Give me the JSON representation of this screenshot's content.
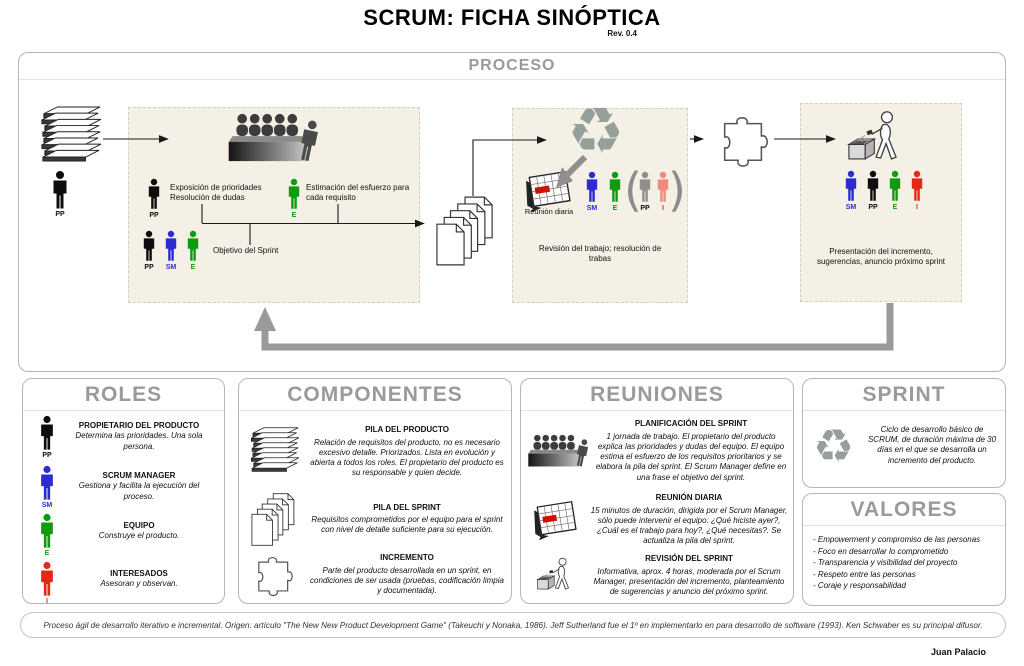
{
  "title": "SCRUM: FICHA SINÓPTICA",
  "revision": "Rev. 0.4",
  "author": "Juan Palacio",
  "footer": "Proceso ágil de desarrollo iterativo e incremental. Origen: artículo \"The New New Product Development Game\" (Takeuchi y Nonaka, 1986). Jeff Sutherland fue el 1º en implementarlo en para desarrollo de software (1993). Ken Schwaber es su principal difusor.",
  "labels": {
    "pp": "PP",
    "sm": "SM",
    "e": "E",
    "i": "I"
  },
  "icons": {
    "recycle": "♻",
    "paren_open": "(",
    "paren_close": ")"
  },
  "colors": {
    "pp": "#0d0d0d",
    "sm": "#2b2bd0",
    "e": "#0f9b0f",
    "i": "#e3281a",
    "ghost_pp": "#8f8f8f",
    "ghost_i": "#f0897f",
    "beige": "#f5f0e6",
    "gray_heading": "#9a9a9a",
    "arrow_gray": "#9a9a9a",
    "board_red": "#cf1000"
  },
  "proceso": {
    "heading": "PROCESO",
    "box1": {
      "exposicion": "Exposición de prioridades\nResolución de dudas",
      "estimacion": "Estimación del esfuerzo para cada requisito",
      "objetivo": "Objetivo del Sprint"
    },
    "box2": {
      "reunion_diaria": "Reunión diaria",
      "revision": "Revisión del trabajo; resolución de trabas"
    },
    "box3": {
      "presentacion": "Presentación del incremento, sugerencias, anuncio próximo sprint"
    }
  },
  "roles": {
    "heading": "ROLES",
    "items": [
      {
        "label": "PP",
        "title": "PROPIETARIO DEL PRODUCTO",
        "desc": "Determina las prioridades. Una sola persona."
      },
      {
        "label": "SM",
        "title": "SCRUM MANAGER",
        "desc": "Gestiona y facilita la ejecución del proceso."
      },
      {
        "label": "E",
        "title": "EQUIPO",
        "desc": "Construye el producto."
      },
      {
        "label": "I",
        "title": "INTERESADOS",
        "desc": "Asesoran y observan."
      }
    ]
  },
  "componentes": {
    "heading": "COMPONENTES",
    "items": [
      {
        "title": "PILA DEL PRODUCTO",
        "desc": "Relación de requisitos del producto, no es necesario excesivo detalle. Priorizados. Lista en evolución y abierta a todos los roles.  El propietario del producto es su responsable y quien decide."
      },
      {
        "title": "PILA DEL SPRINT",
        "desc": "Requisitos comprometidos por el equipo para el sprint con nivel de detalle suficiente para su ejecución."
      },
      {
        "title": "INCREMENTO",
        "desc": "Parte del producto desarrollada en un sprint, en condiciones de ser usada (pruebas, codificación limpia y documentada)."
      }
    ]
  },
  "reuniones": {
    "heading": "REUNIONES",
    "items": [
      {
        "title": "PLANIFICACIÓN DEL SPRINT",
        "desc": "1 jornada de trabajo. El propietario del producto explica las prioridades y  dudas del equipo. El equipo estima el esfuerzo de los requisitos prioritarios y se elabora la pila del sprint. El Scrum Manager define en una frase el objetivo del sprint."
      },
      {
        "title": "REUNIÓN DIARIA",
        "desc": "15 minutos de duración, dirigida por el Scrum Manager, sólo puede intervenir el equipo: ¿Qué hiciste ayer?, ¿Cuál es el trabajo para hoy?, ¿Qué necesitas?. Se actualiza la pila del sprint."
      },
      {
        "title": "REVISIÓN DEL SPRINT",
        "desc": "Informativa, aprox. 4 horas, moderada por el Scrum Manager, presentación del incremento, planteamiento de sugerencias y anuncio del próximo sprint."
      }
    ]
  },
  "sprint": {
    "heading": "SPRINT",
    "desc": "Ciclo de desarrollo básico de SCRUM, de duración máxima de 30 días en el que se desarrolla un incremento del producto."
  },
  "valores": {
    "heading": "VALORES",
    "items": [
      "- Empowerment y compromiso de las personas",
      "- Foco en desarrollar lo comprometido",
      "- Transparencia y visibilidad del proyecto",
      "- Respeto entre las personas",
      "- Coraje y responsabilidad"
    ]
  }
}
